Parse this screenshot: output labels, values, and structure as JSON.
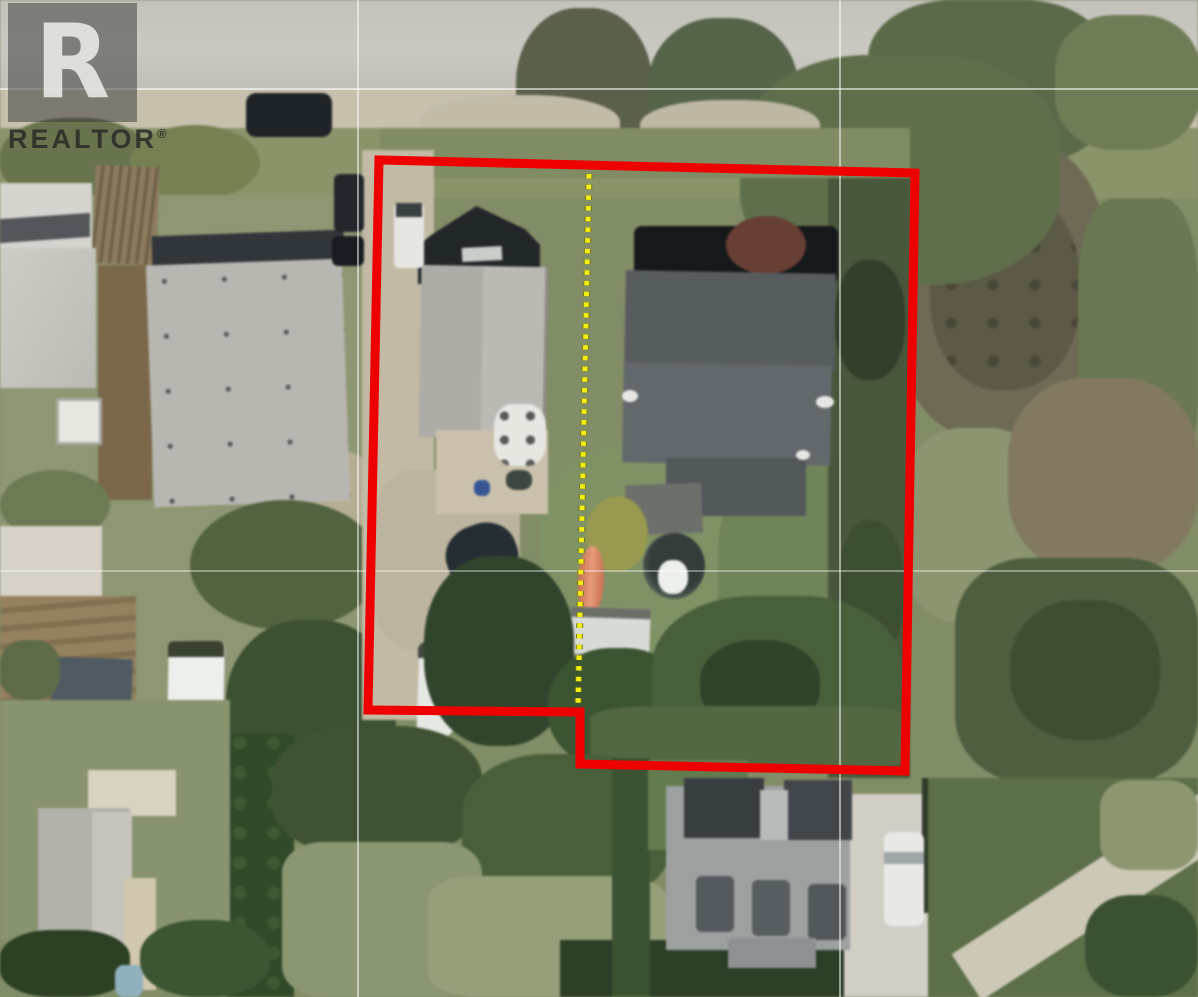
{
  "watermark": {
    "logo_letter": "R",
    "label": "REALTOR",
    "registered_mark": "®"
  },
  "map_overlay": {
    "boundary_color": "#ee0000",
    "boundary_stroke_width": 9,
    "boundary_points": "379,160 915,173 905,771 580,764 580,712 368,710",
    "divider_color": "#f2ed13",
    "divider_casing_color": "#7a7608",
    "divider": {
      "x1": 589,
      "y1": 174,
      "x2": 578,
      "y2": 708
    },
    "gridline_color": "#ffffff",
    "gridlines_horizontal": [
      89,
      571
    ],
    "gridlines_vertical": [
      358,
      840
    ]
  }
}
